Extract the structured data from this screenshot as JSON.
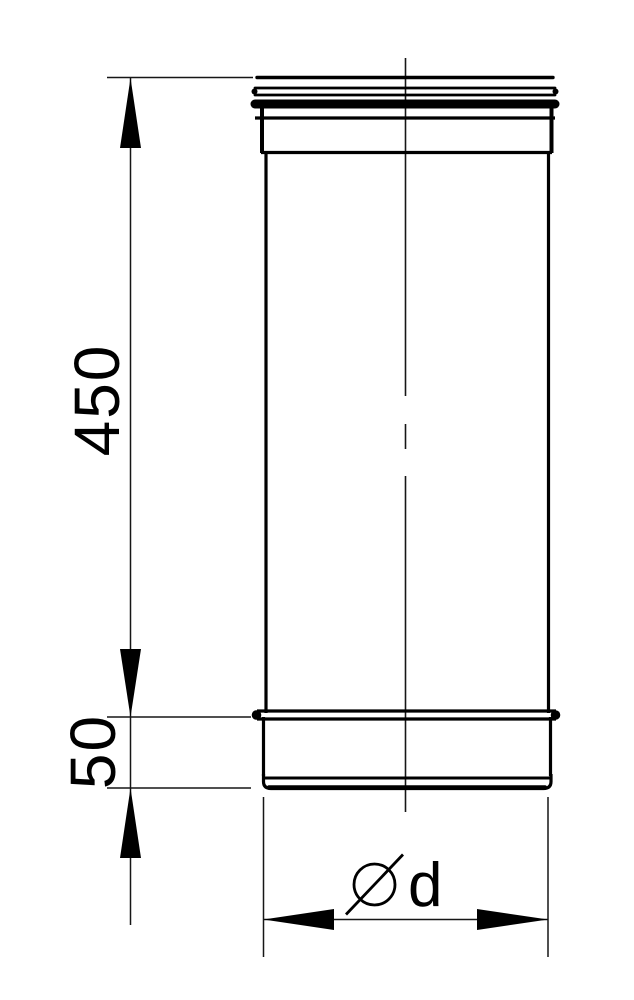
{
  "drawing": {
    "background_color": "#ffffff",
    "outline_color": "#000000",
    "dimension_line_color": "#1a1a1a",
    "dimensions": {
      "height_main": "450",
      "height_socket": "50",
      "diameter_symbol": "⌀",
      "diameter_label": "d"
    }
  }
}
